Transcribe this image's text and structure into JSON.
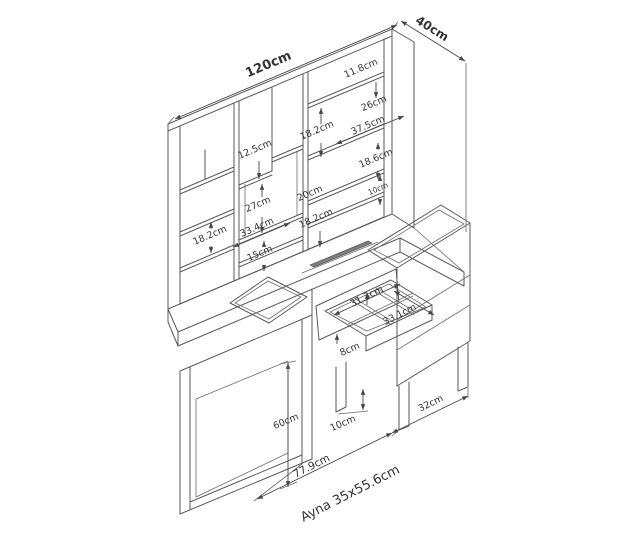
{
  "drawing": {
    "overall": {
      "width": "120cm",
      "depth": "40cm"
    },
    "hutch": {
      "left_cell_height": "18.2cm",
      "mid_top_left_height": "12.5cm",
      "mid_top_right_height": "18.2cm",
      "mid_box_height": "27cm",
      "mid_depth": "20cm",
      "mid_lower_height": "18.2cm",
      "mid_width": "33.4cm",
      "mid_bottom_height": "15cm",
      "right_top_height": "11.8cm",
      "right_upper_height": "26cm",
      "right_width": "37.5cm",
      "right_mid_height": "18.6cm",
      "right_small_height": "10cm"
    },
    "drawer": {
      "inner_width": "31.3cm",
      "inner_depth": "33.1cm",
      "front_height": "8cm"
    },
    "base": {
      "table_height": "60cm",
      "leg_height": "10cm",
      "cabinet_depth": "32cm",
      "front_span": "77.9cm"
    },
    "mirror_note": "Ayna 35x55.6cm"
  }
}
